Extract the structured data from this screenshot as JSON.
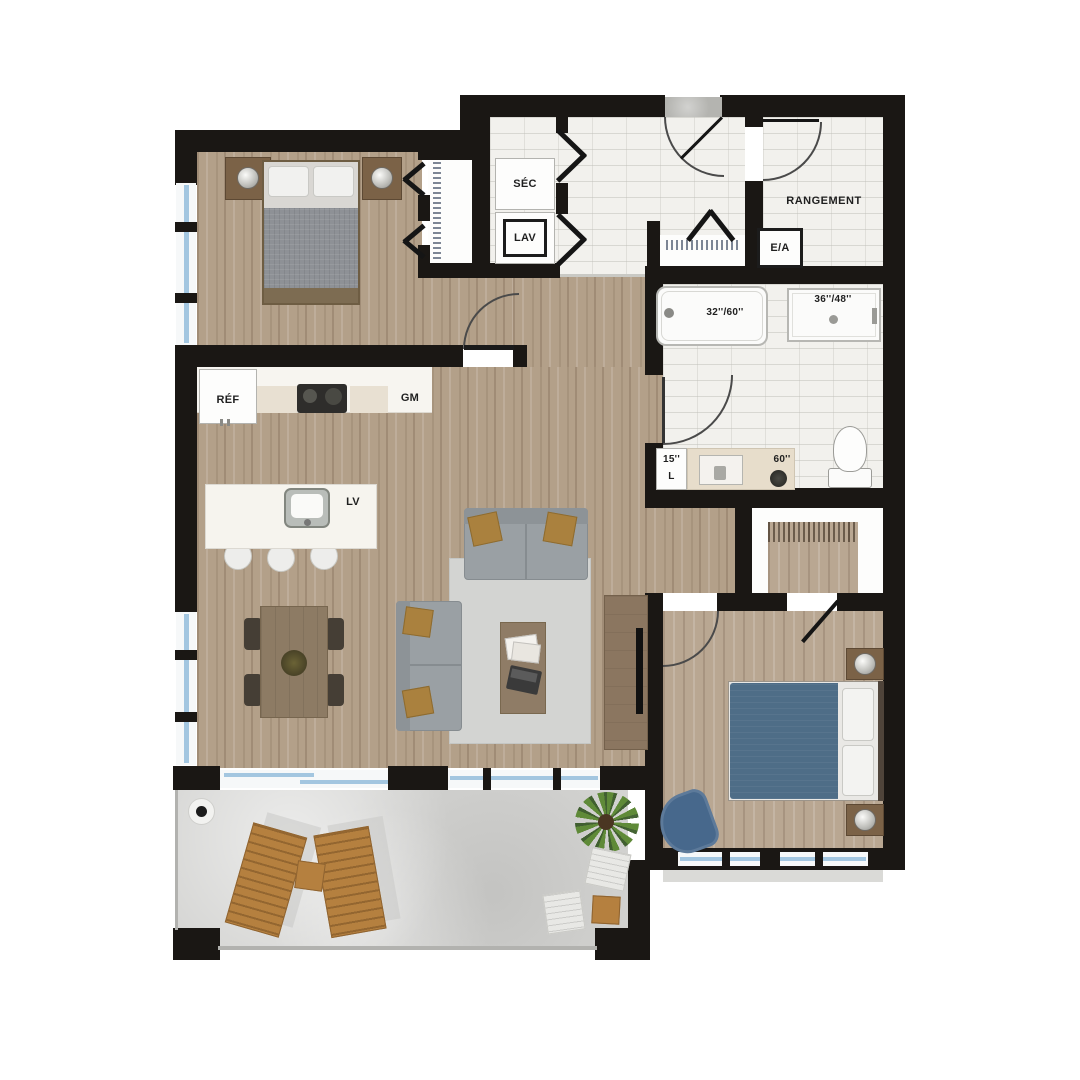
{
  "labels": {
    "dryer": "SÉC",
    "washer": "LAV",
    "storage": "RANGEMENT",
    "air_exchanger": "E/A",
    "bathtub": "32''/60''",
    "vanity": "36''/48''",
    "fridge": "RÉF",
    "pantry": "GM",
    "dishwasher": "LV",
    "linen_width": "15''",
    "linen_letter": "L",
    "makeup_counter": "60''"
  },
  "colors": {
    "wall": "#1a1714",
    "wood_floor": "#b3a089",
    "tile_floor": "#f2f1ed",
    "concrete_floor": "#d4d4d2",
    "bed1_duvet": "#8e9196",
    "bed2_duvet": "#4e6d87",
    "terrace_wood": "#b5803f",
    "sofa": "#9aa0a4"
  }
}
